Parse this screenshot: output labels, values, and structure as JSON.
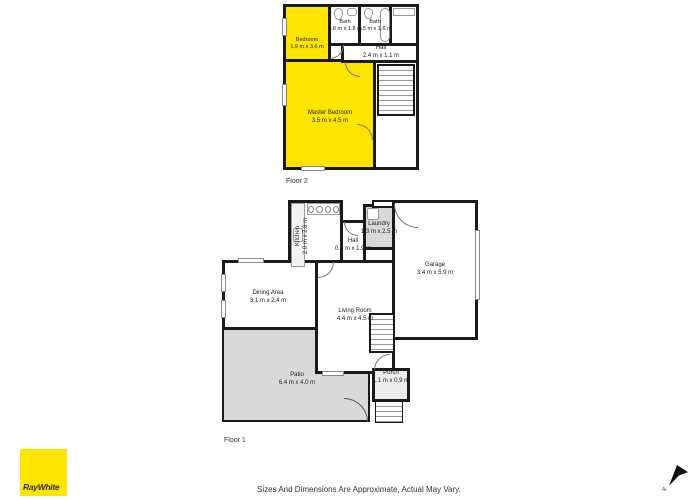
{
  "branding": {
    "logo_text": "RayWhite",
    "logo_bg": "#ffe600"
  },
  "disclaimer": "Sizes And Dimensions Are Approximate, Actual May Vary.",
  "north_arrow_label": "Ai",
  "colors": {
    "highlight_room": "#ffe400",
    "wall": "#1a1a1a",
    "patio_grey": "#d9d9d9",
    "laundry_grey": "#d9d9d9"
  },
  "floors": [
    {
      "label": "Floor 2",
      "rooms": [
        {
          "name": "Bedroom",
          "dims": "1.9 m x 3.6 m"
        },
        {
          "name": "Bath",
          "dims": "0.8 m x 1.8 m"
        },
        {
          "name": "Bath",
          "dims": "1.5 m x 1.6 m"
        },
        {
          "name": "Hall",
          "dims": "2.4 m x 1.1 m"
        },
        {
          "name": "Master Bedroom",
          "dims": "3.5 m x 4.5 m"
        }
      ]
    },
    {
      "label": "Floor 1",
      "rooms": [
        {
          "name": "Kitchen",
          "dims": "2.0 m x 2.8 m"
        },
        {
          "name": "Hall",
          "dims": "0.9 m x 1.9 m"
        },
        {
          "name": "Laundry",
          "dims": "1.3 m x 2.5 m"
        },
        {
          "name": "Garage",
          "dims": "3.4 m x 5.9 m"
        },
        {
          "name": "Dining Area",
          "dims": "3.1 m x 2.4 m"
        },
        {
          "name": "Living Room",
          "dims": "4.4 m x 4.5 m"
        },
        {
          "name": "Patio",
          "dims": "6.4 m x 4.0 m"
        },
        {
          "name": "Porch",
          "dims": "1.1 m x 0.9 m"
        }
      ]
    }
  ]
}
